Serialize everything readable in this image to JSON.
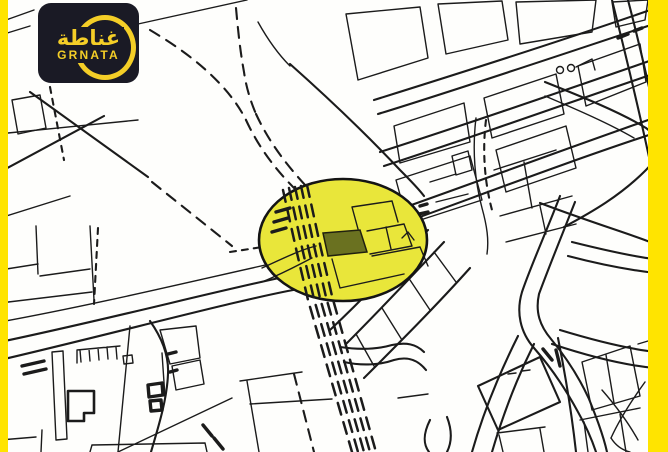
{
  "brand": {
    "logo_arabic": "غناطة",
    "logo_latin": "GRNATA"
  },
  "colors": {
    "frame_yellow": "#FFE400",
    "badge_background": "#1A1A25",
    "badge_yellow": "#F4CE27",
    "map_background": "#FEFEFC",
    "map_line": "#1B1B1B",
    "highlight_fill": "#E9E63A",
    "highlight_outline": "#141414",
    "highlight_plot_fill": "#6A7120",
    "highlight_plot_outline": "#20200f"
  }
}
